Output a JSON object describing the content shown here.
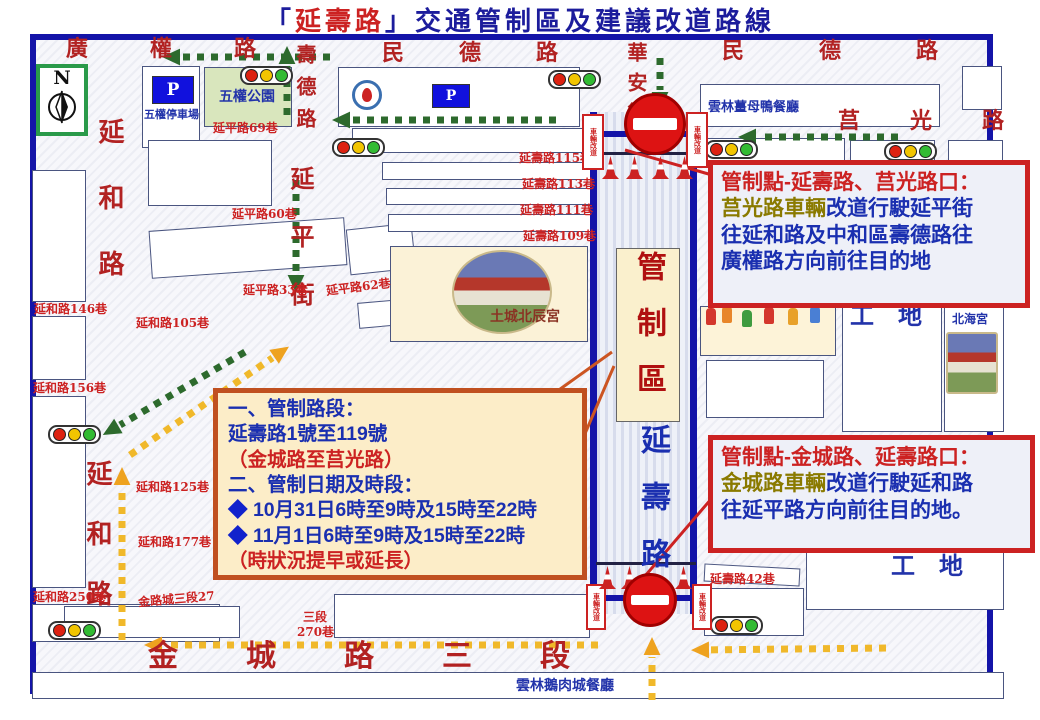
{
  "title": {
    "prefix": "「",
    "road_name": "延壽路",
    "suffix": "」交通管制區及建議改道路線"
  },
  "compass_label": "N",
  "parking_sign_label": "P",
  "barricade_label": "車輛改道",
  "control_zone": {
    "zone_label": "管制區",
    "road_label": "延壽路"
  },
  "info_box_1": {
    "heading": "管制點-延壽路、莒光路口：",
    "subject": "莒光路車輛",
    "body_1": "改道行駛延平街",
    "body_2": "往延和路及中和區壽德路往",
    "body_3": "廣權路方向前往目的地"
  },
  "info_box_2": {
    "heading": "管制點-金城路、延壽路口：",
    "subject": "金城路車輛",
    "body_1": "改道行駛延和路",
    "body_2": "往延平路方向前往目的地。"
  },
  "notice_box": {
    "line_1": "一、管制路段：",
    "line_2": "延壽路1號至119號",
    "line_3": "（金城路至莒光路）",
    "line_4": "二、管制日期及時段：",
    "bullet": "◆",
    "line_5": "10月31日6時至9時及15時至22時",
    "line_6": "11月1日6時至9時及15時至22時",
    "line_7": "（時狀況提早或延長）"
  },
  "colors": {
    "road_label": "#b22222",
    "lane_label": "#cc2222",
    "building_label": "#2233aa",
    "temple_label": "#8a3324",
    "map_border": "#1414a8",
    "green_arrow": "#2d6a2d",
    "yellow_arrow": "#f0b82a",
    "yellow_head": "#eea21f",
    "callout_red": "#cc2222",
    "callout_orange": "#cc5522",
    "light_red": "#dd2211",
    "light_yellow": "#f2c500",
    "light_green": "#33bb33"
  },
  "map_labels": [
    {
      "name": "road-guangquan",
      "text": "廣權路",
      "x": 66,
      "y": 38,
      "fs": 22,
      "ls": 62,
      "c": "road"
    },
    {
      "name": "road-minde-center",
      "text": "民德路",
      "x": 382,
      "y": 42,
      "fs": 22,
      "ls": 55,
      "c": "road"
    },
    {
      "name": "road-minde-right",
      "text": "民德路",
      "x": 722,
      "y": 40,
      "fs": 22,
      "ls": 75,
      "c": "road"
    },
    {
      "name": "road-juguang",
      "text": "莒光路",
      "x": 838,
      "y": 110,
      "fs": 22,
      "ls": 50,
      "c": "road"
    },
    {
      "name": "road-shoude",
      "text": "壽德路",
      "x": 295,
      "y": 44,
      "fs": 20,
      "ls": 12,
      "c": "road",
      "vert": true
    },
    {
      "name": "road-huaan",
      "text": "華安街",
      "x": 626,
      "y": 42,
      "fs": 20,
      "ls": 10,
      "c": "road",
      "vert": true
    },
    {
      "name": "road-yanhe-upper",
      "text": "延和路",
      "x": 96,
      "y": 118,
      "fs": 26,
      "ls": 40,
      "c": "road",
      "vert": true
    },
    {
      "name": "road-yanhe-lower",
      "text": "延和路",
      "x": 84,
      "y": 460,
      "fs": 26,
      "ls": 34,
      "c": "road",
      "vert": true
    },
    {
      "name": "road-yanping-street",
      "text": "延平街",
      "x": 288,
      "y": 166,
      "fs": 24,
      "ls": 34,
      "c": "road",
      "vert": true
    },
    {
      "name": "road-jincheng-sec3",
      "text": "金城路三段",
      "x": 148,
      "y": 642,
      "fs": 30,
      "ls": 68,
      "c": "road"
    },
    {
      "name": "site-gongdi-1",
      "text": "工地",
      "x": 850,
      "y": 304,
      "fs": 24,
      "ls": 24,
      "c": "bld"
    },
    {
      "name": "site-gongdi-2",
      "text": "工地",
      "x": 891,
      "y": 554,
      "fs": 24,
      "ls": 24,
      "c": "bld"
    },
    {
      "name": "lane-yanping-69",
      "text": "延平路69巷",
      "x": 213,
      "y": 122,
      "fs": 12,
      "c": "lane"
    },
    {
      "name": "lane-yanping-60",
      "text": "延平路60巷",
      "x": 232,
      "y": 208,
      "fs": 12,
      "c": "lane"
    },
    {
      "name": "lane-yanping-33",
      "text": "延平路33巷",
      "x": 243,
      "y": 284,
      "fs": 12,
      "c": "lane"
    },
    {
      "name": "lane-yanping-62",
      "text": "延平路62巷",
      "x": 326,
      "y": 281,
      "fs": 12,
      "c": "lane",
      "rot": -7
    },
    {
      "name": "lane-yanshou-115",
      "text": "延壽路115巷",
      "x": 519,
      "y": 152,
      "fs": 12,
      "c": "lane"
    },
    {
      "name": "lane-yanshou-113",
      "text": "延壽路113巷",
      "x": 522,
      "y": 178,
      "fs": 12,
      "c": "lane"
    },
    {
      "name": "lane-yanshou-111",
      "text": "延壽路111巷",
      "x": 520,
      "y": 204,
      "fs": 12,
      "c": "lane"
    },
    {
      "name": "lane-yanshou-109",
      "text": "延壽路109巷",
      "x": 523,
      "y": 230,
      "fs": 12,
      "c": "lane"
    },
    {
      "name": "lane-yanshou-42",
      "text": "延壽路42巷",
      "x": 710,
      "y": 573,
      "fs": 12,
      "c": "lane"
    },
    {
      "name": "lane-yanhe-146",
      "text": "延和路146巷",
      "x": 34,
      "y": 303,
      "fs": 12,
      "c": "lane"
    },
    {
      "name": "lane-yanhe-105",
      "text": "延和路105巷",
      "x": 136,
      "y": 317,
      "fs": 12,
      "c": "lane"
    },
    {
      "name": "lane-yanhe-156",
      "text": "延和路156巷",
      "x": 33,
      "y": 382,
      "fs": 12,
      "c": "lane"
    },
    {
      "name": "lane-yanhe-125",
      "text": "延和路125巷",
      "x": 136,
      "y": 481,
      "fs": 12,
      "c": "lane"
    },
    {
      "name": "lane-yanhe-177",
      "text": "延和路177巷",
      "x": 138,
      "y": 536,
      "fs": 12,
      "c": "lane"
    },
    {
      "name": "lane-yanhe-250",
      "text": "延和路250巷",
      "x": 33,
      "y": 591,
      "fs": 12,
      "c": "lane"
    },
    {
      "name": "lane-jinchengsec3-27",
      "text": "金路城三段27",
      "x": 138,
      "y": 593,
      "fs": 12,
      "c": "lane",
      "rot": -5
    },
    {
      "name": "lane-sec3",
      "text": "三段",
      "x": 303,
      "y": 611,
      "fs": 12,
      "c": "lane"
    },
    {
      "name": "lane-270",
      "text": "270巷",
      "x": 297,
      "y": 626,
      "fs": 12,
      "c": "lane"
    },
    {
      "name": "bld-wuquan-parking",
      "text": "五權停車場",
      "x": 144,
      "y": 109,
      "fs": 11,
      "c": "bld"
    },
    {
      "name": "bld-wuquan-park",
      "text": "五權公園",
      "x": 219,
      "y": 90,
      "fs": 14,
      "c": "bld"
    },
    {
      "name": "bld-jiangmuya-restaurant",
      "text": "雲林薑母鴨餐廳",
      "x": 708,
      "y": 101,
      "fs": 13,
      "c": "bld"
    },
    {
      "name": "bld-beihai-temple",
      "text": "北海宮",
      "x": 952,
      "y": 313,
      "fs": 12,
      "c": "bld"
    },
    {
      "name": "bld-eroucheng-restaurant",
      "text": "雲林鵝肉城餐廳",
      "x": 516,
      "y": 679,
      "fs": 14,
      "c": "bld"
    },
    {
      "name": "bld-beichen-temple",
      "text": "土城北辰宮",
      "x": 490,
      "y": 310,
      "fs": 14,
      "c": "temple"
    }
  ],
  "buildings": [
    {
      "name": "wuquan-parking-lot",
      "x": 142,
      "y": 66,
      "w": 58,
      "h": 82
    },
    {
      "name": "wuquan-park",
      "x": 204,
      "y": 67,
      "w": 88,
      "h": 60,
      "fill": "#d9e6bd"
    },
    {
      "name": "hospital-block",
      "x": 338,
      "y": 67,
      "w": 242,
      "h": 60
    },
    {
      "name": "jiangmuya-block",
      "x": 700,
      "y": 84,
      "w": 240,
      "h": 43
    },
    {
      "name": "block",
      "x": 962,
      "y": 66,
      "w": 40,
      "h": 44
    },
    {
      "name": "block",
      "x": 695,
      "y": 138,
      "w": 150,
      "h": 30
    },
    {
      "name": "block",
      "x": 850,
      "y": 140,
      "w": 85,
      "h": 28
    },
    {
      "name": "block",
      "x": 948,
      "y": 140,
      "w": 55,
      "h": 28
    },
    {
      "name": "block",
      "x": 32,
      "y": 170,
      "w": 54,
      "h": 132
    },
    {
      "name": "block",
      "x": 32,
      "y": 316,
      "w": 54,
      "h": 64
    },
    {
      "name": "block",
      "x": 32,
      "y": 396,
      "w": 54,
      "h": 192
    },
    {
      "name": "block",
      "x": 32,
      "y": 604,
      "w": 188,
      "h": 38
    },
    {
      "name": "block",
      "x": 148,
      "y": 140,
      "w": 124,
      "h": 66
    },
    {
      "name": "block",
      "x": 150,
      "y": 224,
      "w": 196,
      "h": 48,
      "rot": -4
    },
    {
      "name": "block",
      "x": 348,
      "y": 226,
      "w": 66,
      "h": 46,
      "rot": -6
    },
    {
      "name": "block",
      "x": 358,
      "y": 298,
      "w": 112,
      "h": 26,
      "rot": -5
    },
    {
      "name": "block",
      "x": 352,
      "y": 128,
      "w": 240,
      "h": 25
    },
    {
      "name": "block",
      "x": 382,
      "y": 162,
      "w": 210,
      "h": 18
    },
    {
      "name": "block",
      "x": 386,
      "y": 188,
      "w": 206,
      "h": 17
    },
    {
      "name": "block",
      "x": 388,
      "y": 214,
      "w": 204,
      "h": 18
    },
    {
      "name": "beichen-temple-block",
      "x": 390,
      "y": 246,
      "w": 198,
      "h": 96,
      "fill": "#fbf2d7"
    },
    {
      "name": "parade-block",
      "x": 700,
      "y": 306,
      "w": 136,
      "h": 50,
      "fill": "#fdf3d8"
    },
    {
      "name": "block",
      "x": 706,
      "y": 360,
      "w": 118,
      "h": 58
    },
    {
      "name": "gongdi-column",
      "x": 842,
      "y": 300,
      "w": 100,
      "h": 132
    },
    {
      "name": "beihai-column",
      "x": 944,
      "y": 300,
      "w": 60,
      "h": 132
    },
    {
      "name": "block",
      "x": 704,
      "y": 566,
      "w": 96,
      "h": 18,
      "rot": 3
    },
    {
      "name": "block",
      "x": 704,
      "y": 588,
      "w": 100,
      "h": 48
    },
    {
      "name": "gongdi-south-block",
      "x": 806,
      "y": 552,
      "w": 198,
      "h": 58
    },
    {
      "name": "block",
      "x": 64,
      "y": 606,
      "w": 176,
      "h": 32
    },
    {
      "name": "block",
      "x": 334,
      "y": 594,
      "w": 256,
      "h": 44
    },
    {
      "name": "south-strip",
      "x": 32,
      "y": 672,
      "w": 972,
      "h": 27
    }
  ],
  "bars": [
    {
      "x": 590,
      "y": 112,
      "w": 7,
      "h": 502
    },
    {
      "x": 690,
      "y": 112,
      "w": 7,
      "h": 502
    },
    {
      "x": 588,
      "y": 131,
      "w": 108,
      "h": 6
    },
    {
      "x": 586,
      "y": 595,
      "w": 112,
      "h": 6
    },
    {
      "x": 598,
      "y": 152,
      "w": 92,
      "h": 3,
      "c": "#222244"
    },
    {
      "x": 596,
      "y": 562,
      "w": 100,
      "h": 3,
      "c": "#222244"
    }
  ],
  "traffic_lights": [
    {
      "x": 240,
      "y": 66
    },
    {
      "x": 548,
      "y": 70
    },
    {
      "x": 705,
      "y": 140
    },
    {
      "x": 884,
      "y": 142
    },
    {
      "x": 332,
      "y": 138
    },
    {
      "x": 48,
      "y": 425
    },
    {
      "x": 48,
      "y": 621
    },
    {
      "x": 710,
      "y": 616
    }
  ],
  "no_entry_signs": [
    {
      "cx": 655,
      "cy": 124,
      "r": 31
    },
    {
      "cx": 650,
      "cy": 600,
      "r": 27
    }
  ],
  "cones": [
    {
      "x": 602,
      "y": 156
    },
    {
      "x": 626,
      "y": 156
    },
    {
      "x": 652,
      "y": 156
    },
    {
      "x": 676,
      "y": 156
    },
    {
      "x": 599,
      "y": 566
    },
    {
      "x": 621,
      "y": 566
    },
    {
      "x": 675,
      "y": 566
    }
  ],
  "barricades": [
    {
      "x": 582,
      "y": 114,
      "w": 22,
      "h": 56
    },
    {
      "x": 686,
      "y": 112,
      "w": 22,
      "h": 56
    },
    {
      "x": 586,
      "y": 584,
      "w": 20,
      "h": 46
    },
    {
      "x": 692,
      "y": 584,
      "w": 20,
      "h": 46
    }
  ],
  "p_signs": [
    {
      "x": 152,
      "y": 76,
      "w": 42,
      "h": 28
    },
    {
      "x": 432,
      "y": 84,
      "w": 38,
      "h": 24
    }
  ],
  "photos": [
    {
      "name": "beichen-temple-photo",
      "x": 452,
      "y": 250,
      "w": 96,
      "h": 80,
      "oval": true
    },
    {
      "name": "beihai-temple-photo",
      "x": 946,
      "y": 332,
      "w": 48,
      "h": 58,
      "oval": false
    }
  ],
  "arrows": [
    {
      "color": "green",
      "x1": 330,
      "y1": 57,
      "x2": 168,
      "y2": 57
    },
    {
      "color": "green",
      "x1": 287,
      "y1": 115,
      "x2": 287,
      "y2": 52
    },
    {
      "color": "green",
      "x1": 296,
      "y1": 180,
      "x2": 296,
      "y2": 287
    },
    {
      "color": "green",
      "x1": 245,
      "y1": 352,
      "x2": 108,
      "y2": 432
    },
    {
      "color": "green",
      "x1": 556,
      "y1": 120,
      "x2": 338,
      "y2": 120
    },
    {
      "color": "green",
      "x1": 898,
      "y1": 137,
      "x2": 744,
      "y2": 137
    },
    {
      "color": "green",
      "x1": 660,
      "y1": 58,
      "x2": 660,
      "y2": 104
    },
    {
      "color": "yellow",
      "x1": 598,
      "y1": 645,
      "x2": 150,
      "y2": 645
    },
    {
      "color": "yellow",
      "x1": 886,
      "y1": 648,
      "x2": 697,
      "y2": 650
    },
    {
      "color": "yellow",
      "x1": 122,
      "y1": 640,
      "x2": 122,
      "y2": 473
    },
    {
      "color": "yellow",
      "x1": 130,
      "y1": 455,
      "x2": 284,
      "y2": 350
    },
    {
      "color": "yellow",
      "x1": 652,
      "y1": 700,
      "x2": 652,
      "y2": 643
    }
  ],
  "callout_lines": [
    {
      "x1": 712,
      "y1": 175,
      "x2": 625,
      "y2": 150,
      "c": "red"
    },
    {
      "x1": 556,
      "y1": 392,
      "x2": 612,
      "y2": 352,
      "c": "orange"
    },
    {
      "x1": 584,
      "y1": 436,
      "x2": 614,
      "y2": 366,
      "c": "orange"
    },
    {
      "x1": 712,
      "y1": 498,
      "x2": 633,
      "y2": 590,
      "c": "red"
    }
  ],
  "parade_figures": [
    {
      "x": 706,
      "y": 308,
      "c": "#d4372c"
    },
    {
      "x": 722,
      "y": 306,
      "c": "#e8862a"
    },
    {
      "x": 742,
      "y": 310,
      "c": "#3f9b3f"
    },
    {
      "x": 764,
      "y": 307,
      "c": "#d4372c"
    },
    {
      "x": 788,
      "y": 308,
      "c": "#e8a12a"
    },
    {
      "x": 810,
      "y": 306,
      "c": "#4a7fd4"
    }
  ]
}
